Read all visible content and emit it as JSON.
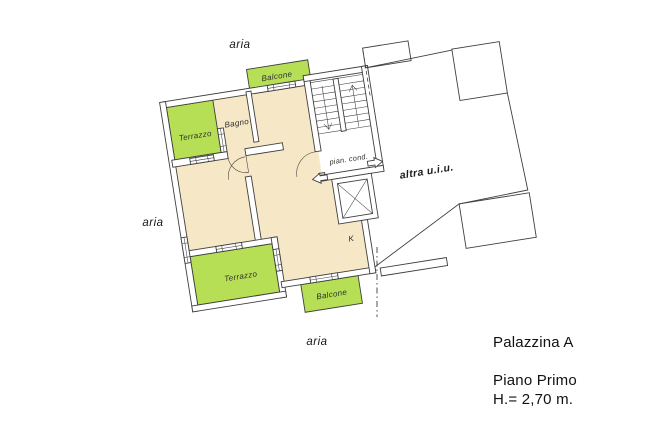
{
  "title_block": {
    "building": "Palazzina A",
    "floor": "Piano Primo",
    "height": "H.= 2,70 m."
  },
  "plan": {
    "rooms": {
      "bathroom": "Bagno",
      "kitchen_mark": "K"
    },
    "outdoor": {
      "balcony_top": "Balcone",
      "balcony_bottom": "Balcone",
      "terrace_upper": "Terrazzo",
      "terrace_lower": "Terrazzo"
    },
    "common": {
      "landing": "pian. cond."
    },
    "other_unit": "altra u.i.u.",
    "air_labels": {
      "top": "aria",
      "left": "aria",
      "bottom": "aria"
    }
  },
  "colors": {
    "background": "#ffffff",
    "apartment_fill": "#f6e8c6",
    "outdoor_fill": "#b6df55",
    "line": "#3f3f3f",
    "text": "#111111"
  }
}
